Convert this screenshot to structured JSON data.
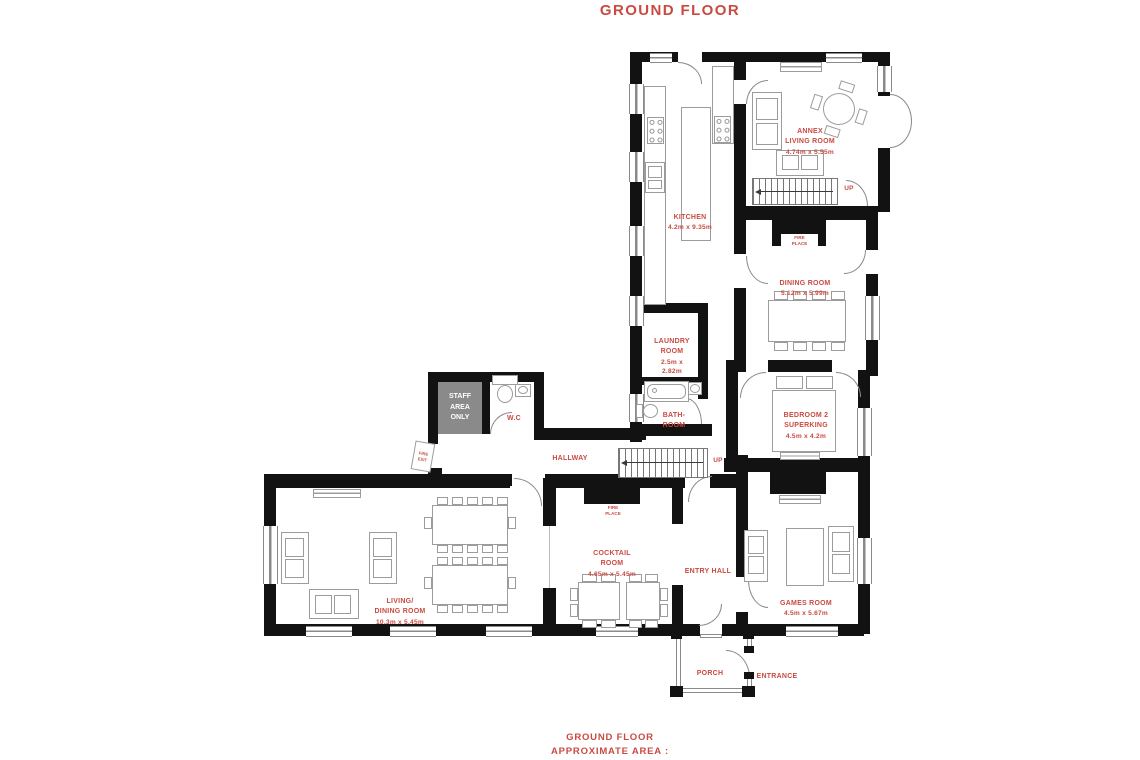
{
  "title": "GROUND FLOOR",
  "footer": {
    "line1": "GROUND FLOOR",
    "line2": "APPROXIMATE AREA :"
  },
  "colors": {
    "accent": "#c94a41",
    "wall": "#121212",
    "staff_fill": "#8a8a8a"
  },
  "labels": {
    "annex": {
      "name": "ANNEX\nLIVING ROOM",
      "dims": "4.74m x 5.55m"
    },
    "kitchen": {
      "name": "KITCHEN",
      "dims": "4.2m x 9.35m"
    },
    "dining": {
      "name": "DINING ROOM",
      "dims": "5.12m x 5.99m"
    },
    "laundry": {
      "name": "LAUNDRY\nROOM",
      "dims": "2.5m x\n2.82m"
    },
    "bathroom": {
      "name": "BATH-\nROOM"
    },
    "bedroom2": {
      "name": "BEDROOM 2\nSUPERKING",
      "dims": "4.5m x 4.2m"
    },
    "wc": {
      "name": "W.C"
    },
    "hallway": {
      "name": "HALLWAY"
    },
    "cocktail": {
      "name": "COCKTAIL\nROOM",
      "dims": "4.65m x 5.45m"
    },
    "entry_hall": {
      "name": "ENTRY HALL"
    },
    "living_dining": {
      "name": "LIVING/\nDINING ROOM",
      "dims": "10.3m x 5.45m"
    },
    "games": {
      "name": "GAMES ROOM",
      "dims": "4.5m x 5.67m"
    },
    "porch": {
      "name": "PORCH"
    },
    "entrance": {
      "name": "ENTRANCE"
    },
    "staff_area": {
      "name": "STAFF\nAREA\nONLY"
    },
    "fire_exit": {
      "name": "FIRE\nEXIT"
    },
    "fireplace": {
      "name": "FIRE\nPLACE"
    },
    "up": {
      "name": "UP"
    }
  }
}
